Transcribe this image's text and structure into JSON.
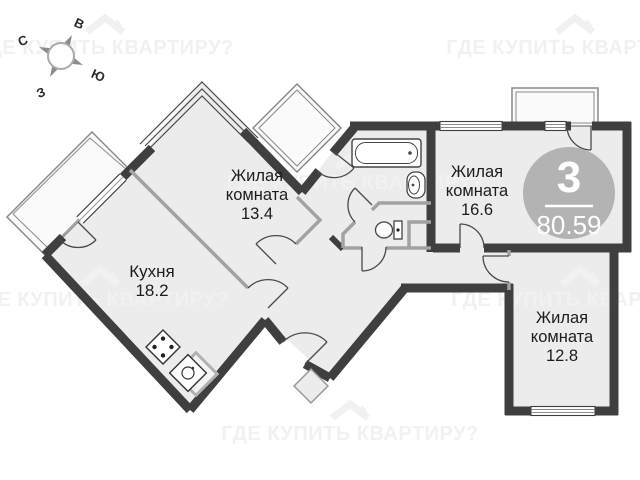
{
  "plan": {
    "type": "apartment-floor-plan",
    "badge": {
      "rooms_count": "3",
      "total_area": "80.59"
    },
    "rooms": [
      {
        "id": "living-13-4",
        "lines": [
          "Жилая",
          "комната",
          "13.4"
        ]
      },
      {
        "id": "kitchen",
        "lines": [
          "Кухня",
          "18.2"
        ]
      },
      {
        "id": "living-16-6",
        "lines": [
          "Жилая",
          "комната",
          "16.6"
        ]
      },
      {
        "id": "living-12-8",
        "lines": [
          "Жилая",
          "комната",
          "12.8"
        ]
      }
    ],
    "compass": {
      "north": "С",
      "east": "В",
      "south": "Ю",
      "west": "З"
    },
    "watermark": {
      "text": "ГДЕ КУПИТЬ КВАРТИРУ?"
    },
    "fixtures": [
      "bathtub",
      "bath-sink",
      "toilet",
      "stove",
      "kitchen-sink",
      "counter"
    ],
    "colors": {
      "wall": "#3f3f3f",
      "floor": "#ececec",
      "partition": "#a2a2a2",
      "balcony_line": "#8a8a8a",
      "badge": "#b3b3b3",
      "watermark": "#f1f1f1"
    }
  }
}
